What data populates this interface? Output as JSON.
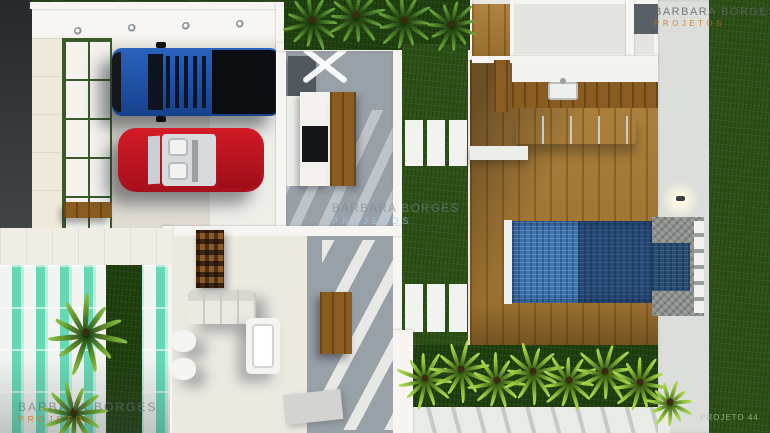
{
  "image_type": "3d-architectural-floorplan-render",
  "brand": {
    "name": "Barbara Borges Projetos",
    "accent_orange": "#c87014",
    "accent_pale_blue": "#a0c8eb"
  },
  "watermarks": {
    "top_right": {
      "line1": "BARBARA BORGES",
      "line2": "PROJETOS"
    },
    "center": {
      "line1": "BARBARA BORGES",
      "line2": "PROJETOS"
    },
    "bottom_left": {
      "line1": "BARBARA BORGES",
      "line2": "PROJETOS"
    },
    "bottom_right_note": "PROJETO 44"
  },
  "scene": {
    "areas": [
      "garage",
      "kitchen",
      "living-room",
      "gourmet-barbecue-area",
      "wood-deck",
      "pool",
      "lawn",
      "entry-pergola"
    ],
    "colors": {
      "lawn_green": "#2c5016",
      "deck_wood": "#a87830",
      "pool_water": "#3e76b2",
      "pergola_glass_teal": "#66d8b6",
      "truck_blue": "#1c4da2",
      "car_red": "#bf1620",
      "floor_light": "#e9e7e1",
      "floor_grey": "#98a0a8"
    }
  }
}
